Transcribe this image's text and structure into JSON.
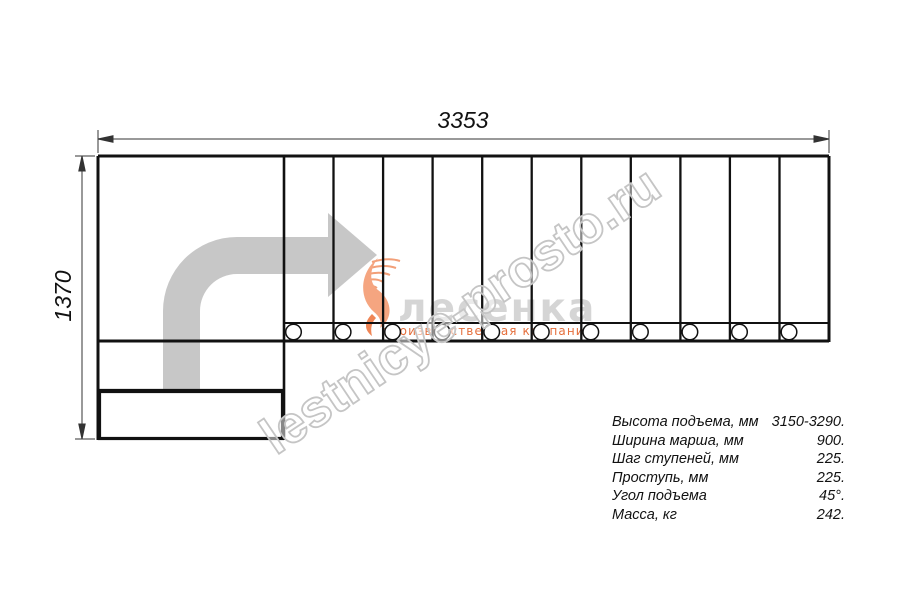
{
  "drawing": {
    "title": "staircase-top-view-plan",
    "width_dim": "3353",
    "height_dim": "1370",
    "steps_count": 11
  },
  "watermark": {
    "text": "lestnicye-prosto.ru"
  },
  "logo": {
    "name": "лесенка",
    "subtitle": "производственная компания"
  },
  "specs": {
    "rows": [
      {
        "label": "Высота подъема, мм",
        "value": "3150-3290."
      },
      {
        "label": "Ширина марша, мм",
        "value": "900."
      },
      {
        "label": "Шаг ступеней, мм",
        "value": "225."
      },
      {
        "label": "Проступь, мм",
        "value": "225."
      },
      {
        "label": "Угол подъема",
        "value": "45°."
      },
      {
        "label": "Масса, кг",
        "value": "242."
      }
    ]
  },
  "colors": {
    "line": "#111111",
    "dimension_line": "#333333",
    "arrow_gray": "#c7c7c7",
    "watermark_gray": "#c5c5c5",
    "logo_gray": "#d5d5d5",
    "logo_orange": "#e56f3c"
  }
}
